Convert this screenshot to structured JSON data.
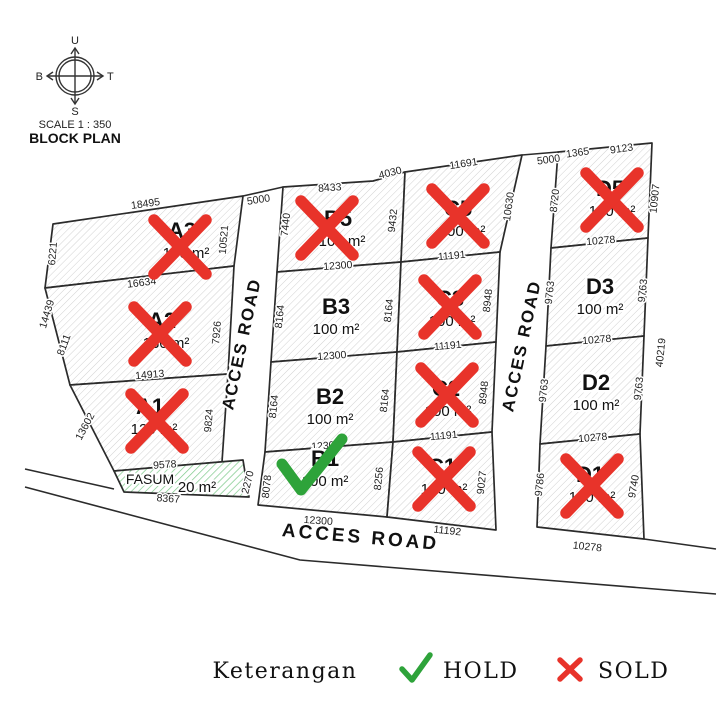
{
  "compass": {
    "north": "U",
    "east": "T",
    "south": "S",
    "west": "B",
    "scale": "SCALE 1 : 350",
    "title": "BLOCK PLAN"
  },
  "legend": {
    "title": "Keterangan",
    "hold_label": "HOLD",
    "sold_label": "SOLD",
    "hold_color": "#2ea33a",
    "sold_color": "#e8332a"
  },
  "colors": {
    "line": "#2b2b2b",
    "hatch": "#cccccc",
    "green_hatch": "#7cc98a",
    "sold_x": "#e8332a",
    "hold_check": "#2ea33a"
  },
  "roads": [
    {
      "label": "ACCES ROAD",
      "x": 247,
      "y": 345,
      "r": -78,
      "big": false
    },
    {
      "label": "ACCES ROAD",
      "x": 527,
      "y": 347,
      "r": -78,
      "big": false
    },
    {
      "label": "ACCES ROAD",
      "x": 360,
      "y": 543,
      "r": 5,
      "big": true
    }
  ],
  "plots": [
    {
      "id": "A3",
      "name": "A3",
      "area": "140 m²",
      "status": "sold",
      "points": [
        [
          53,
          224
        ],
        [
          243,
          196
        ],
        [
          234,
          266
        ],
        [
          45,
          288
        ]
      ],
      "lx": 182,
      "ly": 238,
      "ax": 186,
      "ay": 258,
      "mx": 180,
      "my": 247
    },
    {
      "id": "A2",
      "name": "A2",
      "area": "130 m²",
      "status": "sold",
      "points": [
        [
          45,
          288
        ],
        [
          234,
          266
        ],
        [
          228,
          374
        ],
        [
          70,
          385
        ]
      ],
      "lx": 162,
      "ly": 328,
      "ax": 166,
      "ay": 348,
      "mx": 160,
      "my": 334
    },
    {
      "id": "A1",
      "name": "A1",
      "area": "120 m²",
      "status": "sold",
      "points": [
        [
          70,
          385
        ],
        [
          228,
          374
        ],
        [
          222,
          462
        ],
        [
          114,
          471
        ]
      ],
      "lx": 150,
      "ly": 414,
      "ax": 154,
      "ay": 434,
      "mx": 157,
      "my": 421
    },
    {
      "id": "FASUM",
      "name": "FASUM",
      "area": "20 m²",
      "status": "none",
      "fasum": true,
      "points": [
        [
          114,
          471
        ],
        [
          243,
          460
        ],
        [
          249,
          497
        ],
        [
          124,
          492
        ]
      ],
      "lx": 150,
      "ly": 484,
      "ax": 197,
      "ay": 492
    },
    {
      "id": "B5",
      "name": "B5",
      "area": "100 m²",
      "status": "sold",
      "points": [
        [
          283,
          187
        ],
        [
          373,
          181
        ],
        [
          405,
          172
        ],
        [
          401,
          262
        ],
        [
          277,
          272
        ]
      ],
      "lx": 338,
      "ly": 226,
      "ax": 342,
      "ay": 246,
      "mx": 327,
      "my": 228
    },
    {
      "id": "B3",
      "name": "B3",
      "area": "100 m²",
      "status": "none",
      "points": [
        [
          277,
          272
        ],
        [
          401,
          262
        ],
        [
          397,
          352
        ],
        [
          271,
          362
        ]
      ],
      "lx": 336,
      "ly": 314,
      "ax": 336,
      "ay": 334
    },
    {
      "id": "B2",
      "name": "B2",
      "area": "100 m²",
      "status": "none",
      "points": [
        [
          271,
          362
        ],
        [
          397,
          352
        ],
        [
          393,
          442
        ],
        [
          265,
          452
        ]
      ],
      "lx": 330,
      "ly": 404,
      "ax": 330,
      "ay": 424
    },
    {
      "id": "B1",
      "name": "B1",
      "area": "100 m²",
      "status": "hold",
      "points": [
        [
          265,
          452
        ],
        [
          393,
          442
        ],
        [
          387,
          517
        ],
        [
          258,
          505
        ]
      ],
      "lx": 325,
      "ly": 466,
      "ax": 325,
      "ay": 486,
      "mx": 308,
      "my": 466
    },
    {
      "id": "C5",
      "name": "C5",
      "area": "100 m²",
      "status": "sold",
      "points": [
        [
          405,
          172
        ],
        [
          522,
          155
        ],
        [
          500,
          252
        ],
        [
          401,
          262
        ]
      ],
      "lx": 458,
      "ly": 216,
      "ax": 462,
      "ay": 236,
      "mx": 458,
      "my": 216
    },
    {
      "id": "C3",
      "name": "C3",
      "area": "100 m²",
      "status": "sold",
      "points": [
        [
          401,
          262
        ],
        [
          500,
          252
        ],
        [
          496,
          342
        ],
        [
          397,
          352
        ]
      ],
      "lx": 450,
      "ly": 306,
      "ax": 452,
      "ay": 326,
      "mx": 450,
      "my": 307
    },
    {
      "id": "C2",
      "name": "C2",
      "area": "100 m²",
      "status": "sold",
      "points": [
        [
          397,
          352
        ],
        [
          496,
          342
        ],
        [
          492,
          432
        ],
        [
          393,
          442
        ]
      ],
      "lx": 446,
      "ly": 396,
      "ax": 448,
      "ay": 416,
      "mx": 447,
      "my": 395
    },
    {
      "id": "C1",
      "name": "C1",
      "area": "100 m²",
      "status": "sold",
      "points": [
        [
          393,
          442
        ],
        [
          492,
          432
        ],
        [
          496,
          530
        ],
        [
          387,
          517
        ]
      ],
      "lx": 442,
      "ly": 474,
      "ax": 444,
      "ay": 494,
      "mx": 444,
      "my": 479
    },
    {
      "id": "D5",
      "name": "D5",
      "area": "100 m²",
      "status": "sold",
      "points": [
        [
          558,
          152
        ],
        [
          652,
          143
        ],
        [
          648,
          238
        ],
        [
          551,
          248
        ]
      ],
      "lx": 610,
      "ly": 196,
      "ax": 612,
      "ay": 216,
      "mx": 612,
      "my": 200
    },
    {
      "id": "D3",
      "name": "D3",
      "area": "100 m²",
      "status": "none",
      "points": [
        [
          551,
          248
        ],
        [
          648,
          238
        ],
        [
          644,
          336
        ],
        [
          546,
          346
        ]
      ],
      "lx": 600,
      "ly": 294,
      "ax": 600,
      "ay": 314
    },
    {
      "id": "D2",
      "name": "D2",
      "area": "100 m²",
      "status": "none",
      "points": [
        [
          546,
          346
        ],
        [
          644,
          336
        ],
        [
          640,
          434
        ],
        [
          540,
          444
        ]
      ],
      "lx": 596,
      "ly": 390,
      "ax": 596,
      "ay": 410
    },
    {
      "id": "D1",
      "name": "D1",
      "area": "100 m²",
      "status": "sold",
      "points": [
        [
          540,
          444
        ],
        [
          640,
          434
        ],
        [
          644,
          539
        ],
        [
          537,
          527
        ]
      ],
      "lx": 590,
      "ly": 482,
      "ax": 592,
      "ay": 502,
      "mx": 592,
      "my": 486
    }
  ],
  "lines": [
    [
      [
        243,
        196
      ],
      [
        283,
        187
      ]
    ],
    [
      [
        522,
        155
      ],
      [
        558,
        152
      ]
    ],
    [
      [
        25,
        469
      ],
      [
        114,
        489
      ]
    ],
    [
      [
        25,
        487
      ],
      [
        300,
        560
      ],
      [
        716,
        594
      ]
    ],
    [
      [
        644,
        539
      ],
      [
        716,
        549
      ]
    ]
  ],
  "dimensions": [
    {
      "t": "18495",
      "x": 146,
      "y": 207,
      "r": -8
    },
    {
      "t": "6221",
      "x": 56,
      "y": 254,
      "r": -85
    },
    {
      "t": "10521",
      "x": 227,
      "y": 240,
      "r": -85
    },
    {
      "t": "16634",
      "x": 142,
      "y": 286,
      "r": -7
    },
    {
      "t": "14439",
      "x": 50,
      "y": 315,
      "r": -73
    },
    {
      "t": "8111",
      "x": 67,
      "y": 346,
      "r": -70
    },
    {
      "t": "7926",
      "x": 220,
      "y": 333,
      "r": -85
    },
    {
      "t": "14913",
      "x": 150,
      "y": 378,
      "r": -5
    },
    {
      "t": "13602",
      "x": 88,
      "y": 428,
      "r": -62
    },
    {
      "t": "9824",
      "x": 212,
      "y": 421,
      "r": -85
    },
    {
      "t": "9578",
      "x": 165,
      "y": 468,
      "r": -4
    },
    {
      "t": "8367",
      "x": 168,
      "y": 502,
      "r": 4
    },
    {
      "t": "2270",
      "x": 251,
      "y": 483,
      "r": -76
    },
    {
      "t": "5000",
      "x": 259,
      "y": 203,
      "r": -9
    },
    {
      "t": "5000",
      "x": 549,
      "y": 163,
      "r": -8
    },
    {
      "t": "1365",
      "x": 578,
      "y": 156,
      "r": -8
    },
    {
      "t": "8433",
      "x": 330,
      "y": 191,
      "r": -4
    },
    {
      "t": "4030",
      "x": 391,
      "y": 176,
      "r": -14
    },
    {
      "t": "7440",
      "x": 289,
      "y": 225,
      "r": -84
    },
    {
      "t": "9432",
      "x": 396,
      "y": 221,
      "r": -84
    },
    {
      "t": "12300",
      "x": 338,
      "y": 269,
      "r": -4
    },
    {
      "t": "8164",
      "x": 283,
      "y": 317,
      "r": -84
    },
    {
      "t": "8164",
      "x": 392,
      "y": 311,
      "r": -84
    },
    {
      "t": "12300",
      "x": 332,
      "y": 359,
      "r": -4
    },
    {
      "t": "8164",
      "x": 277,
      "y": 407,
      "r": -84
    },
    {
      "t": "8164",
      "x": 388,
      "y": 401,
      "r": -84
    },
    {
      "t": "12300",
      "x": 326,
      "y": 449,
      "r": -4
    },
    {
      "t": "8078",
      "x": 270,
      "y": 487,
      "r": -84
    },
    {
      "t": "8256",
      "x": 382,
      "y": 479,
      "r": -84
    },
    {
      "t": "12300",
      "x": 318,
      "y": 524,
      "r": 4
    },
    {
      "t": "11691",
      "x": 464,
      "y": 167,
      "r": -9
    },
    {
      "t": "10630",
      "x": 512,
      "y": 207,
      "r": -82
    },
    {
      "t": "11191",
      "x": 452,
      "y": 259,
      "r": -5
    },
    {
      "t": "8948",
      "x": 491,
      "y": 301,
      "r": -84
    },
    {
      "t": "11191",
      "x": 448,
      "y": 349,
      "r": -5
    },
    {
      "t": "8948",
      "x": 487,
      "y": 393,
      "r": -84
    },
    {
      "t": "11191",
      "x": 444,
      "y": 439,
      "r": -5
    },
    {
      "t": "9027",
      "x": 485,
      "y": 483,
      "r": -84
    },
    {
      "t": "11192",
      "x": 447,
      "y": 534,
      "r": 6
    },
    {
      "t": "9123",
      "x": 622,
      "y": 152,
      "r": -8
    },
    {
      "t": "8720",
      "x": 558,
      "y": 201,
      "r": -84
    },
    {
      "t": "10907",
      "x": 658,
      "y": 199,
      "r": -84
    },
    {
      "t": "10278",
      "x": 601,
      "y": 244,
      "r": -5
    },
    {
      "t": "9763",
      "x": 553,
      "y": 293,
      "r": -84
    },
    {
      "t": "9763",
      "x": 646,
      "y": 291,
      "r": -84
    },
    {
      "t": "10278",
      "x": 597,
      "y": 343,
      "r": -5
    },
    {
      "t": "9763",
      "x": 547,
      "y": 391,
      "r": -84
    },
    {
      "t": "9763",
      "x": 642,
      "y": 389,
      "r": -84
    },
    {
      "t": "10278",
      "x": 593,
      "y": 441,
      "r": -5
    },
    {
      "t": "9786",
      "x": 543,
      "y": 485,
      "r": -84
    },
    {
      "t": "9740",
      "x": 637,
      "y": 487,
      "r": -80
    },
    {
      "t": "10278",
      "x": 587,
      "y": 550,
      "r": 6
    },
    {
      "t": "40219",
      "x": 664,
      "y": 353,
      "r": -84
    }
  ]
}
